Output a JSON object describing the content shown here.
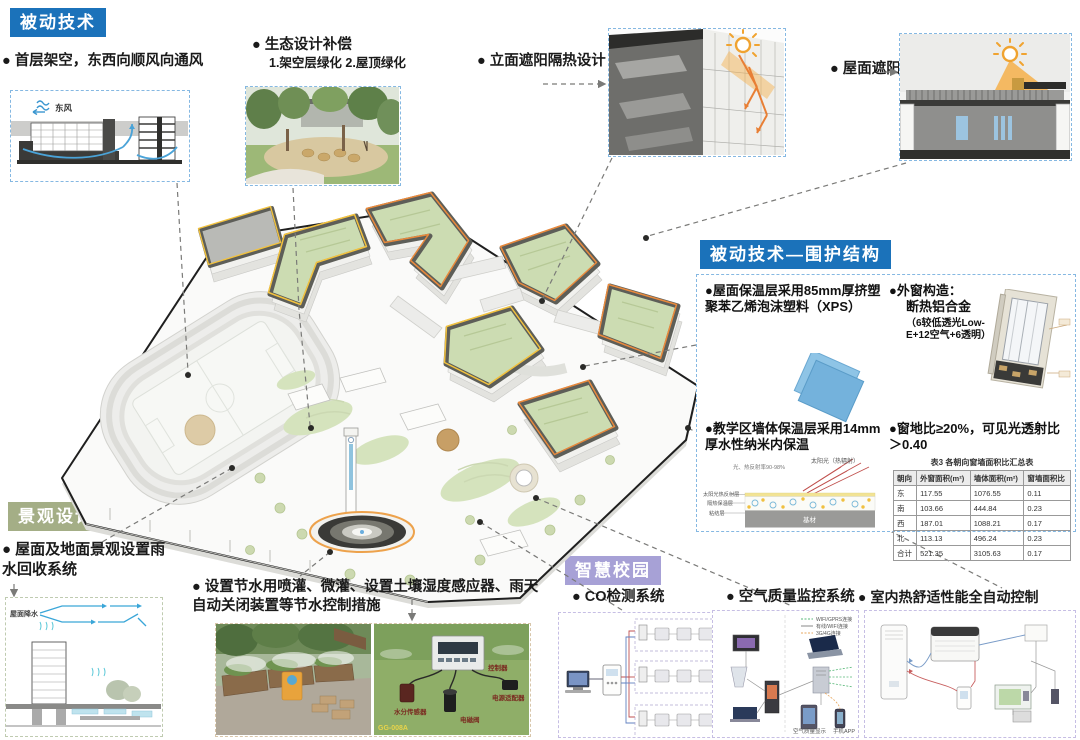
{
  "ui": {
    "bullet": "●"
  },
  "colors": {
    "blue": "#1b72ba",
    "sage_green": "#a4ae86",
    "purple": "#a7a1d6",
    "accent_orange": "#e8893c",
    "accent_yellow": "#f0c030",
    "roof_green": "#ccdcb2"
  },
  "badges": {
    "passive": "被动技术",
    "envelope": "被动技术—围护结构",
    "landscape": "景观设计",
    "smart": "智慧校园"
  },
  "callouts": {
    "stilt": {
      "label": "首层架空，东西向顺风向通风",
      "wind": "东风"
    },
    "eco": {
      "label": "生态设计补偿",
      "sub": "1.架空层绿化  2.屋顶绿化"
    },
    "facade": {
      "label": "立面遮阳隔热设计"
    },
    "roof": {
      "label": "屋面遮阳"
    }
  },
  "envelope": {
    "items": {
      "roof": "屋面保温层采用85mm厚挤塑聚苯乙烯泡沫塑料（XPS）",
      "window_title": "外窗构造：",
      "window_material": "断热铝合金",
      "window_note": "（6较低透光Low-E+12空气+6透明）",
      "wall": "教学区墙体保温层采用14mm厚水性纳米内保温",
      "ratio": "窗地比≥20%，可见光透射比＞0.40"
    },
    "wall_diagram": {
      "sun": "太阳光（热辐射）",
      "note": "光、热反射率90-98%",
      "layer1": "太阳光热反射层",
      "layer2": "隔热保温层",
      "layer3": "粘结层",
      "base": "基材"
    },
    "table": {
      "title": "表3 各朝向窗墙面积比汇总表",
      "headers": [
        "朝向",
        "外窗面积(m²)",
        "墙体面积(m²)",
        "窗墙面积比"
      ],
      "rows": [
        [
          "东",
          "117.55",
          "1076.55",
          "0.11"
        ],
        [
          "南",
          "103.66",
          "444.84",
          "0.23"
        ],
        [
          "西",
          "187.01",
          "1088.21",
          "0.17"
        ],
        [
          "北",
          "113.13",
          "496.24",
          "0.23"
        ],
        [
          "合计",
          "521.35",
          "3105.63",
          "0.17"
        ]
      ]
    }
  },
  "landscape": {
    "bullet": "屋面及地面景观设置雨水回收系统",
    "rain_label": "屋面降水"
  },
  "water": {
    "bullet": "设置节水用喷灌、微灌、设置土壤湿度感应器、雨天自动关闭装置等节水控制措施",
    "device": {
      "controller": "控制器",
      "sensor": "水分传感器",
      "valve": "电磁阀",
      "power": "电源适配器",
      "model": "GG-008A"
    }
  },
  "smart": {
    "co": "CO检测系统",
    "air": "空气质量监控系统",
    "heat": "室内热舒适性能全自动控制",
    "legend": [
      "WIFI/GPRS连接",
      "有线/WIFI连接",
      "3G/4G连接"
    ],
    "air_labels": {
      "app": "手机APP",
      "display": "空气质量显示"
    }
  }
}
